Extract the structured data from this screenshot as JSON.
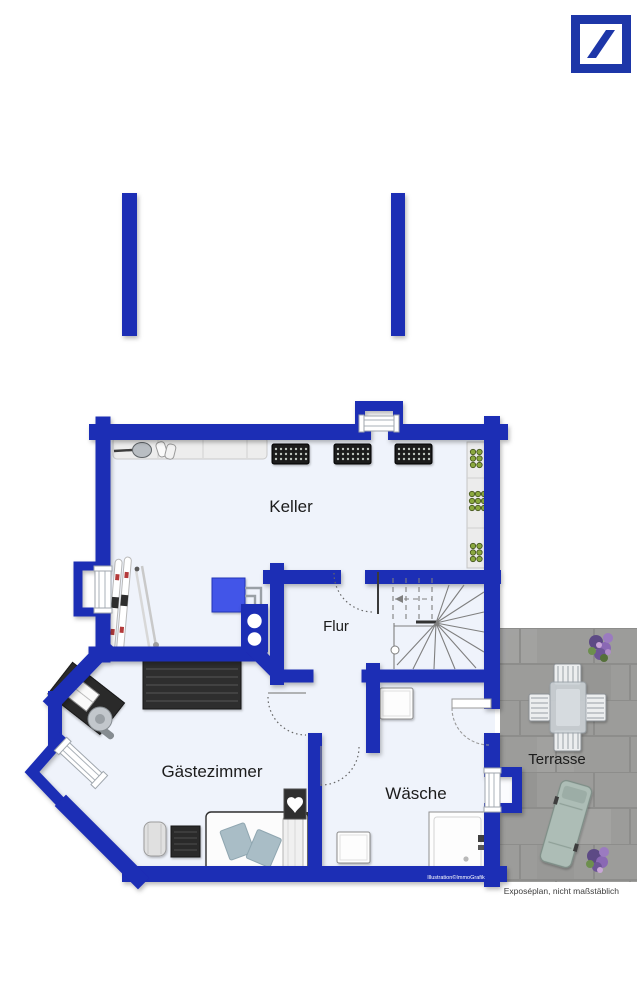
{
  "header": {
    "logo_alt": "Deutsche Bank slash logo"
  },
  "rooms": {
    "keller": "Keller",
    "flur": "Flur",
    "gaestezimmer": "Gästezimmer",
    "waesche": "Wäsche",
    "terrasse": "Terrasse"
  },
  "footer": {
    "credit": "Illustration©ImmoGrafik",
    "disclaimer": "Exposéplan, nicht maßstäblich"
  },
  "colors": {
    "wall": "#1b2db5",
    "logo": "#1d36a8",
    "room": "#eff3fb",
    "terrace": "#9c9c9a",
    "accent": "#4355e8"
  }
}
